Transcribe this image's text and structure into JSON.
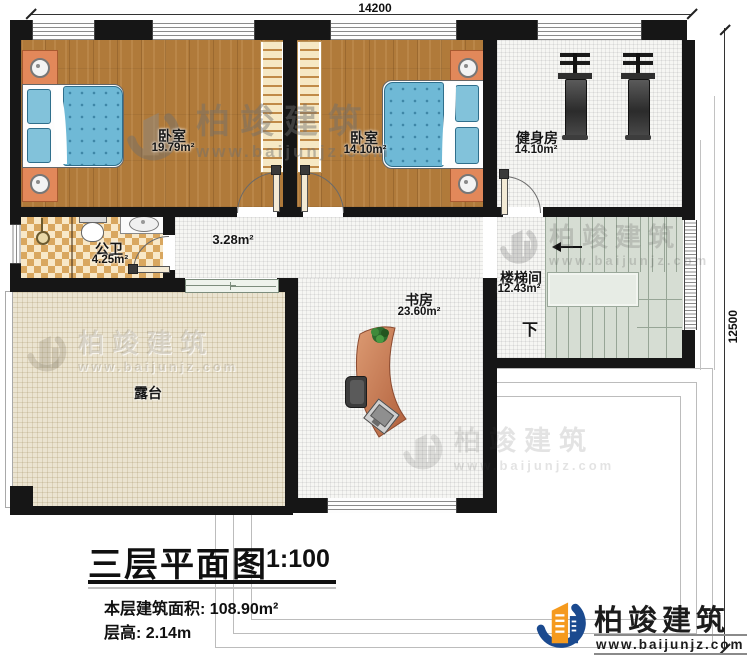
{
  "dimensions": {
    "top": "14200",
    "right": "12500"
  },
  "rooms": {
    "bedroom1": {
      "label": "卧室",
      "area": "19.79m²"
    },
    "bedroom2": {
      "label": "卧室",
      "area": "14.10m²"
    },
    "gym": {
      "label": "健身房",
      "area": "14.10m²"
    },
    "bathroom": {
      "label": "公卫",
      "area": "4.25m²"
    },
    "hallway": {
      "area": "3.28m²"
    },
    "stairwell": {
      "label": "楼梯间",
      "area": "12.43m²",
      "direction_label": "下"
    },
    "study": {
      "label": "书房",
      "area": "23.60m²"
    },
    "terrace": {
      "label": "露台"
    }
  },
  "title_block": {
    "title": "三层平面图",
    "scale": "1:100",
    "area_label": "本层建筑面积:",
    "area_value": "108.90m²",
    "floor_height_label": "层高:",
    "floor_height_value": "2.14m"
  },
  "branding": {
    "company": "柏竣建筑",
    "website": "www.baijunjz.com"
  },
  "colors": {
    "wall": "#161616",
    "wood_floor": "#b07a3a",
    "bed_blue": "#6fb9d6",
    "nightstand_orange": "#e2885a",
    "stairs_green": "#d6ddd3",
    "terrace_beige": "#ebe4d1",
    "bathroom_tile": "#d9a75f",
    "logo_blue": "#1b4a8f",
    "logo_orange": "#f59a1e"
  }
}
